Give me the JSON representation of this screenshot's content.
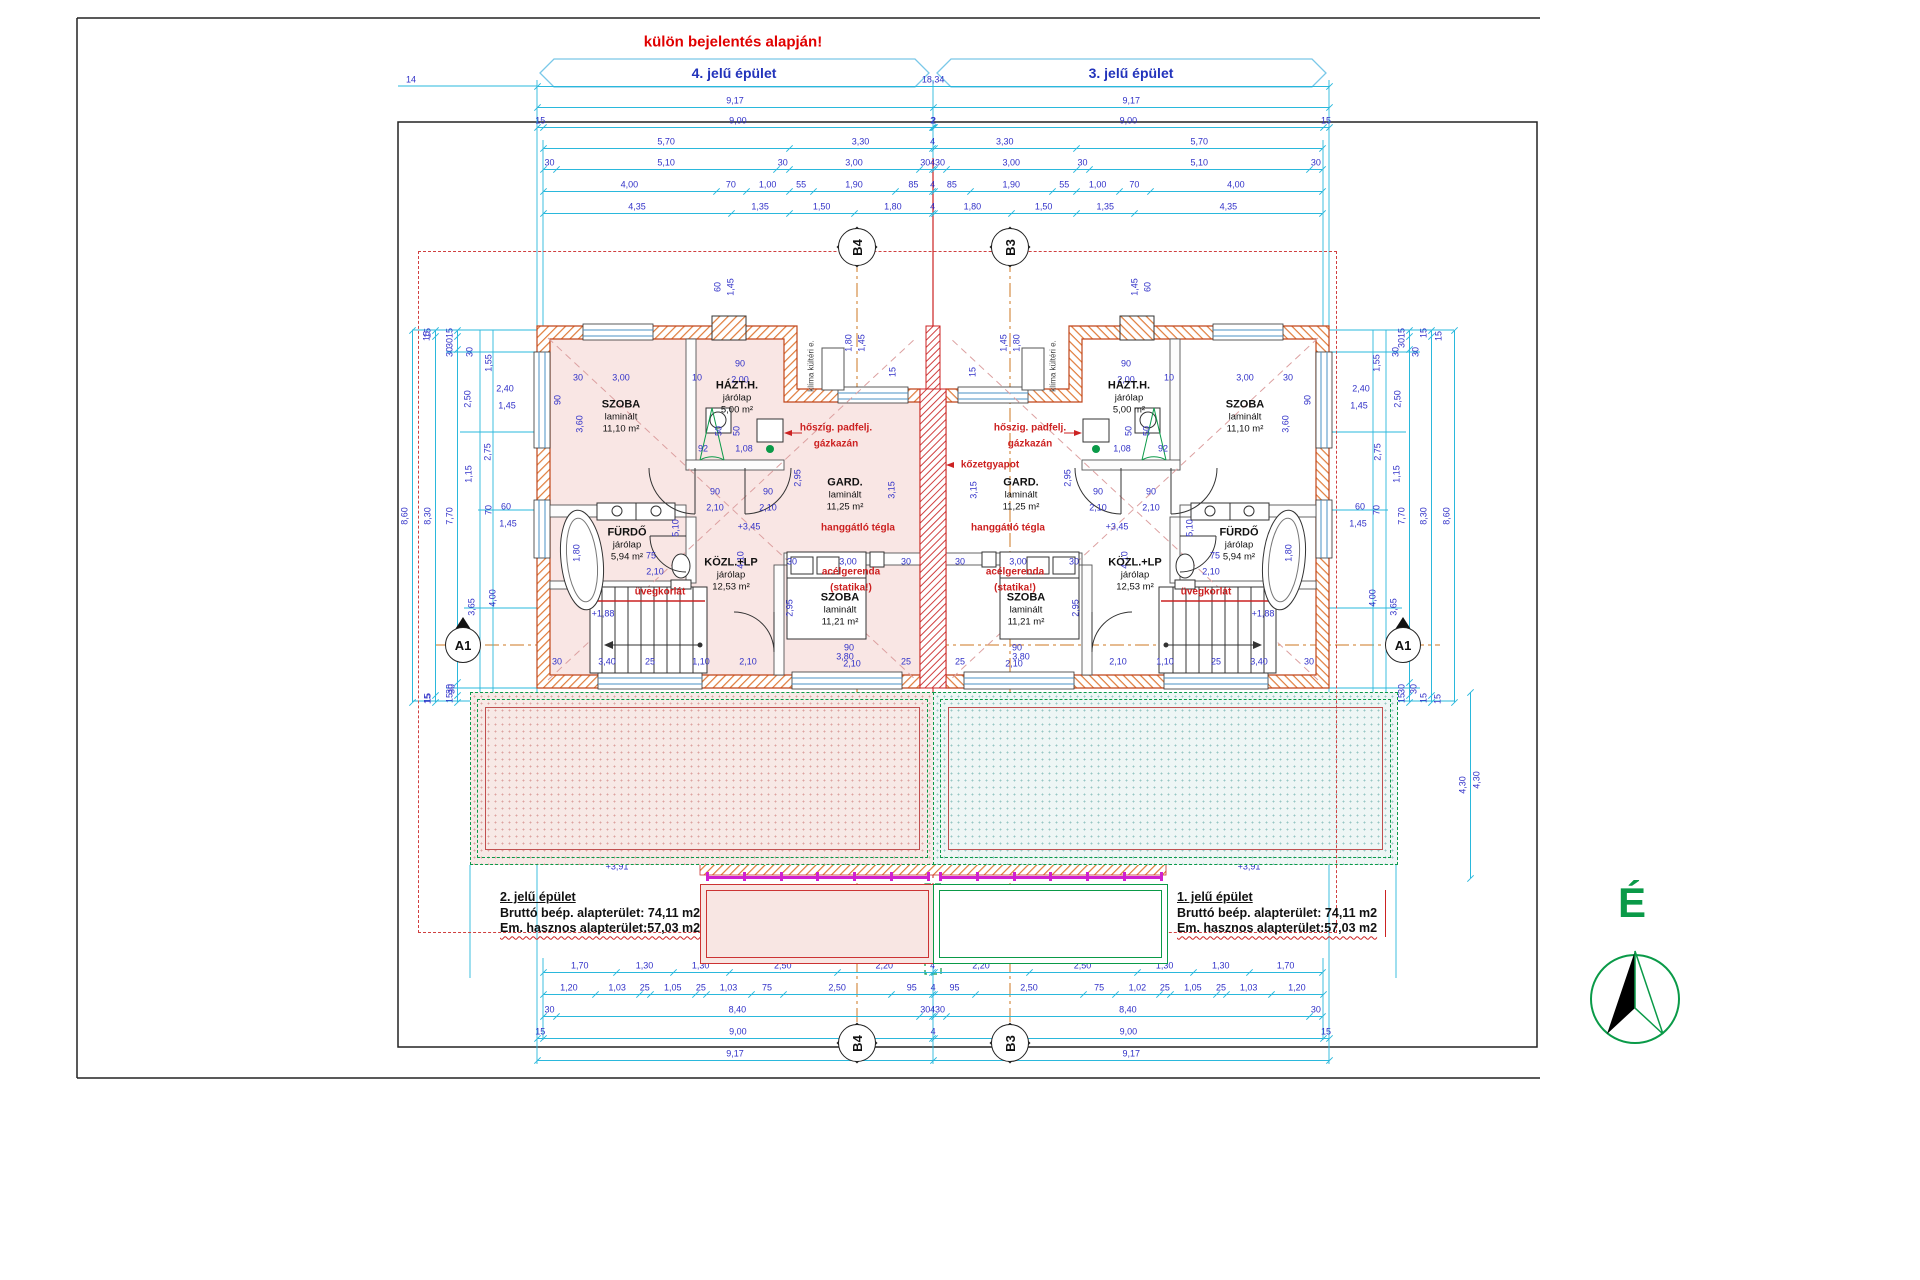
{
  "title": {
    "warning": "külön bejelentés alapján!",
    "left_banner": "4. jelű épület",
    "right_banner": "3. jelű épület"
  },
  "summaries": {
    "left": {
      "heading": "2. jelű épület",
      "line1": "Bruttó beép. alapterület: 74,11 m2",
      "line2": "Em. hasznos alapterület:57,03 m2"
    },
    "right": {
      "heading": "1. jelű épület",
      "line1": "Bruttó beép. alapterület: 74,11 m2",
      "line2": "Em. hasznos alapterület:57,03 m2"
    }
  },
  "compass": {
    "label": "É"
  },
  "colors": {
    "dim_line": "#2ab8dc",
    "dim_text": "#3232c8",
    "red": "#cc2020",
    "green": "#0a9a48",
    "wall": "#e07b39",
    "magenta": "#d020d0"
  },
  "markers": [
    {
      "t": "B4",
      "x": 857,
      "y": 247,
      "k": "grid"
    },
    {
      "t": "B3",
      "x": 1010,
      "y": 247,
      "k": "grid"
    },
    {
      "t": "B4",
      "x": 857,
      "y": 1043,
      "k": "grid"
    },
    {
      "t": "B3",
      "x": 1010,
      "y": 1043,
      "k": "grid"
    },
    {
      "t": "A1",
      "x": 463,
      "y": 645,
      "k": "sec"
    },
    {
      "t": "A1",
      "x": 1403,
      "y": 645,
      "k": "sec"
    }
  ],
  "rooms": [
    {
      "x": 621,
      "y": 417,
      "n": "SZOBA",
      "s": "laminált",
      "a": "11,10 m²"
    },
    {
      "x": 737,
      "y": 398,
      "n": "HÁZT.H.",
      "s": "járólap",
      "a": "5,00 m²"
    },
    {
      "x": 845,
      "y": 495,
      "n": "GARD.",
      "s": "laminált",
      "a": "11,25 m²"
    },
    {
      "x": 627,
      "y": 545,
      "n": "FÜRDŐ",
      "s": "járólap",
      "a": "5,94 m²"
    },
    {
      "x": 731,
      "y": 575,
      "n": "KÖZL.+LP",
      "s": "járólap",
      "a": "12,53 m²"
    },
    {
      "x": 840,
      "y": 610,
      "n": "SZOBA",
      "s": "laminált",
      "a": "11,21 m²"
    },
    {
      "x": 1245,
      "y": 417,
      "n": "SZOBA",
      "s": "laminált",
      "a": "11,10 m²"
    },
    {
      "x": 1129,
      "y": 398,
      "n": "HÁZT.H.",
      "s": "járólap",
      "a": "5,00 m²"
    },
    {
      "x": 1021,
      "y": 495,
      "n": "GARD.",
      "s": "laminált",
      "a": "11,25 m²"
    },
    {
      "x": 1239,
      "y": 545,
      "n": "FÜRDŐ",
      "s": "járólap",
      "a": "5,94 m²"
    },
    {
      "x": 1135,
      "y": 575,
      "n": "KÖZL.+LP",
      "s": "járólap",
      "a": "12,53 m²"
    },
    {
      "x": 1026,
      "y": 610,
      "n": "SZOBA",
      "s": "laminált",
      "a": "11,21 m²"
    }
  ],
  "annotations": [
    {
      "t": "hőszig. padfelj.",
      "x": 836,
      "y": 428
    },
    {
      "t": "gázkazán",
      "x": 836,
      "y": 444
    },
    {
      "t": "hőszig. padfelj.",
      "x": 1030,
      "y": 428
    },
    {
      "t": "gázkazán",
      "x": 1030,
      "y": 444
    },
    {
      "t": "kőzetgyapot",
      "x": 990,
      "y": 465
    },
    {
      "t": "hanggátló tégla",
      "x": 858,
      "y": 528
    },
    {
      "t": "hanggátló tégla",
      "x": 1008,
      "y": 528
    },
    {
      "t": "acélgerenda",
      "x": 851,
      "y": 572
    },
    {
      "t": "(statika!)",
      "x": 851,
      "y": 588
    },
    {
      "t": "acélgerenda",
      "x": 1015,
      "y": 572
    },
    {
      "t": "(statika!)",
      "x": 1015,
      "y": 588
    },
    {
      "t": "üvegkorlát",
      "x": 660,
      "y": 592
    },
    {
      "t": "üvegkorlát",
      "x": 1206,
      "y": 592
    },
    {
      "t": "nem járható lapostető",
      "x": 762,
      "y": 777,
      "cls": "huge"
    },
    {
      "t": "nem járható lapostető",
      "x": 1104,
      "y": 777,
      "cls": "huge"
    },
    {
      "t": "korcolt alu lem.pfedés",
      "x": 816,
      "y": 921,
      "cls": "brown"
    },
    {
      "t": "korcolt alu lem.pfedés",
      "x": 1050,
      "y": 921,
      "cls": "brown"
    },
    {
      "t": "klíma kültéri e.",
      "x": 812,
      "y": 366,
      "cls": "small r"
    },
    {
      "t": "klíma kültéri e.",
      "x": 1054,
      "y": 366,
      "cls": "small r"
    }
  ],
  "dim_chains": [
    {
      "d": "h",
      "x": 537,
      "y": 86,
      "v": [
        "18,34"
      ]
    },
    {
      "d": "h",
      "x": 537,
      "y": 107,
      "v": [
        "9,17",
        "9,17"
      ]
    },
    {
      "d": "h",
      "x": 537,
      "y": 127,
      "v": [
        "15",
        "9,00",
        "2",
        "2",
        "9,00",
        "15"
      ]
    },
    {
      "d": "h",
      "x": 543,
      "y": 148,
      "v": [
        "5,70",
        "3,30",
        "4",
        "3,30",
        "5,70"
      ]
    },
    {
      "d": "h",
      "x": 543,
      "y": 169,
      "v": [
        "30",
        "5,10",
        "30",
        "3,00",
        "30",
        "4",
        "30",
        "3,00",
        "30",
        "5,10",
        "30"
      ]
    },
    {
      "d": "h",
      "x": 543,
      "y": 191,
      "v": [
        "4,00",
        "70",
        "1,00",
        "55",
        "1,90",
        "85",
        "4",
        "85",
        "1,90",
        "55",
        "1,00",
        "70",
        "4,00"
      ]
    },
    {
      "d": "h",
      "x": 543,
      "y": 213,
      "v": [
        "4,35",
        "1,35",
        "1,50",
        "1,80",
        "4",
        "1,80",
        "1,50",
        "1,35",
        "4,35"
      ]
    },
    {
      "d": "h",
      "x": 543,
      "y": 972,
      "v": [
        "1,70",
        "1,30",
        "1,30",
        "2,50",
        "2,20",
        "4",
        "2,20",
        "2,50",
        "1,30",
        "1,30",
        "1,70"
      ]
    },
    {
      "d": "h",
      "x": 543,
      "y": 994,
      "v": [
        "1,20",
        "1,03",
        "25",
        "1,05",
        "25",
        "1,03",
        "75",
        "2,50",
        "95",
        "4",
        "95",
        "2,50",
        "75",
        "1,02",
        "25",
        "1,05",
        "25",
        "1,03",
        "1,20"
      ]
    },
    {
      "d": "h",
      "x": 543,
      "y": 1016,
      "v": [
        "30",
        "8,40",
        "30",
        "4",
        "30",
        "8,40",
        "30"
      ]
    },
    {
      "d": "h",
      "x": 537,
      "y": 1038,
      "v": [
        "15",
        "9,00",
        "4",
        "9,00",
        "15"
      ]
    },
    {
      "d": "h",
      "x": 537,
      "y": 1060,
      "v": [
        "9,17",
        "9,17"
      ]
    },
    {
      "d": "v",
      "x": 412,
      "y": 330,
      "v": [
        "8,60"
      ]
    },
    {
      "d": "v",
      "x": 435,
      "y": 330,
      "v": [
        "15",
        "8,30",
        "15"
      ]
    },
    {
      "d": "v",
      "x": 457,
      "y": 330,
      "v": [
        "15",
        "30",
        "7,70",
        "30",
        "15"
      ]
    },
    {
      "d": "v",
      "x": 1454,
      "y": 330,
      "v": [
        "8,60"
      ]
    },
    {
      "d": "v",
      "x": 1431,
      "y": 330,
      "v": [
        "15",
        "8,30",
        "15"
      ]
    },
    {
      "d": "v",
      "x": 1409,
      "y": 330,
      "v": [
        "15",
        "30",
        "7,70",
        "30",
        "15"
      ]
    },
    {
      "d": "v",
      "x": 1470,
      "y": 692,
      "v": [
        "4,30"
      ]
    }
  ],
  "dim_labels": [
    {
      "t": "14",
      "x": 411,
      "y": 80
    },
    {
      "t": "15",
      "x": 427,
      "y": 336,
      "r": 1
    },
    {
      "t": "30",
      "x": 450,
      "y": 352,
      "r": 1
    },
    {
      "t": "30",
      "x": 470,
      "y": 352,
      "r": 1
    },
    {
      "t": "1,55",
      "x": 489,
      "y": 363,
      "r": 1
    },
    {
      "t": "2,50",
      "x": 468,
      "y": 399,
      "r": 1
    },
    {
      "t": "2,75",
      "x": 488,
      "y": 452,
      "r": 1
    },
    {
      "t": "1,15",
      "x": 469,
      "y": 474,
      "r": 1
    },
    {
      "t": "70",
      "x": 489,
      "y": 510,
      "r": 1
    },
    {
      "t": "3,65",
      "x": 472,
      "y": 607,
      "r": 1
    },
    {
      "t": "4,00",
      "x": 493,
      "y": 598,
      "r": 1
    },
    {
      "t": "30",
      "x": 452,
      "y": 689,
      "r": 1
    },
    {
      "t": "15",
      "x": 428,
      "y": 699,
      "r": 1
    },
    {
      "t": "2,40",
      "x": 505,
      "y": 389
    },
    {
      "t": "1,45",
      "x": 507,
      "y": 406
    },
    {
      "t": "60",
      "x": 506,
      "y": 507
    },
    {
      "t": "1,45",
      "x": 508,
      "y": 524
    },
    {
      "t": "15",
      "x": 1439,
      "y": 336,
      "r": 1
    },
    {
      "t": "30",
      "x": 1416,
      "y": 352,
      "r": 1
    },
    {
      "t": "30",
      "x": 1396,
      "y": 352,
      "r": 1
    },
    {
      "t": "1,55",
      "x": 1377,
      "y": 363,
      "r": 1
    },
    {
      "t": "2,50",
      "x": 1398,
      "y": 399,
      "r": 1
    },
    {
      "t": "2,75",
      "x": 1378,
      "y": 452,
      "r": 1
    },
    {
      "t": "1,15",
      "x": 1397,
      "y": 474,
      "r": 1
    },
    {
      "t": "70",
      "x": 1377,
      "y": 510,
      "r": 1
    },
    {
      "t": "3,65",
      "x": 1394,
      "y": 607,
      "r": 1
    },
    {
      "t": "4,00",
      "x": 1373,
      "y": 598,
      "r": 1
    },
    {
      "t": "30",
      "x": 1414,
      "y": 689,
      "r": 1
    },
    {
      "t": "15",
      "x": 1438,
      "y": 699,
      "r": 1
    },
    {
      "t": "2,40",
      "x": 1361,
      "y": 389
    },
    {
      "t": "1,45",
      "x": 1359,
      "y": 406
    },
    {
      "t": "60",
      "x": 1360,
      "y": 507
    },
    {
      "t": "1,45",
      "x": 1358,
      "y": 524
    },
    {
      "t": "60",
      "x": 718,
      "y": 287,
      "r": 1
    },
    {
      "t": "1,45",
      "x": 731,
      "y": 287,
      "r": 1
    },
    {
      "t": "60",
      "x": 1148,
      "y": 287,
      "r": 1
    },
    {
      "t": "1,45",
      "x": 1135,
      "y": 287,
      "r": 1
    },
    {
      "t": "1,80",
      "x": 849,
      "y": 343,
      "r": 1
    },
    {
      "t": "1,45",
      "x": 862,
      "y": 343,
      "r": 1
    },
    {
      "t": "1,80",
      "x": 1017,
      "y": 343,
      "r": 1
    },
    {
      "t": "1,45",
      "x": 1004,
      "y": 343,
      "r": 1
    },
    {
      "t": "30",
      "x": 578,
      "y": 378
    },
    {
      "t": "3,00",
      "x": 621,
      "y": 378
    },
    {
      "t": "10",
      "x": 697,
      "y": 378
    },
    {
      "t": "90",
      "x": 740,
      "y": 364
    },
    {
      "t": "2,00",
      "x": 740,
      "y": 380
    },
    {
      "t": "30",
      "x": 1288,
      "y": 378
    },
    {
      "t": "3,00",
      "x": 1245,
      "y": 378
    },
    {
      "t": "10",
      "x": 1169,
      "y": 378
    },
    {
      "t": "90",
      "x": 1126,
      "y": 364
    },
    {
      "t": "2,00",
      "x": 1126,
      "y": 380
    },
    {
      "t": "90",
      "x": 558,
      "y": 400,
      "r": 1
    },
    {
      "t": "3,60",
      "x": 580,
      "y": 424,
      "r": 1
    },
    {
      "t": "90",
      "x": 1308,
      "y": 400,
      "r": 1
    },
    {
      "t": "3,60",
      "x": 1286,
      "y": 424,
      "r": 1
    },
    {
      "t": "92",
      "x": 703,
      "y": 449
    },
    {
      "t": "1,08",
      "x": 744,
      "y": 449
    },
    {
      "t": "92",
      "x": 1163,
      "y": 449
    },
    {
      "t": "1,08",
      "x": 1122,
      "y": 449
    },
    {
      "t": "50",
      "x": 719,
      "y": 431,
      "r": 1
    },
    {
      "t": "50",
      "x": 737,
      "y": 431,
      "r": 1
    },
    {
      "t": "50",
      "x": 1147,
      "y": 431,
      "r": 1
    },
    {
      "t": "50",
      "x": 1129,
      "y": 431,
      "r": 1
    },
    {
      "t": "15",
      "x": 893,
      "y": 372,
      "r": 1
    },
    {
      "t": "15",
      "x": 973,
      "y": 372,
      "r": 1
    },
    {
      "t": "90",
      "x": 715,
      "y": 492
    },
    {
      "t": "2,10",
      "x": 715,
      "y": 508
    },
    {
      "t": "90",
      "x": 768,
      "y": 492
    },
    {
      "t": "2,10",
      "x": 768,
      "y": 508
    },
    {
      "t": "90",
      "x": 1151,
      "y": 492
    },
    {
      "t": "2,10",
      "x": 1151,
      "y": 508
    },
    {
      "t": "90",
      "x": 1098,
      "y": 492
    },
    {
      "t": "2,10",
      "x": 1098,
      "y": 508
    },
    {
      "t": "2,95",
      "x": 798,
      "y": 478,
      "r": 1
    },
    {
      "t": "3,15",
      "x": 892,
      "y": 490,
      "r": 1
    },
    {
      "t": "2,95",
      "x": 1068,
      "y": 478,
      "r": 1
    },
    {
      "t": "3,15",
      "x": 974,
      "y": 490,
      "r": 1
    },
    {
      "t": "30",
      "x": 792,
      "y": 562
    },
    {
      "t": "3,00",
      "x": 848,
      "y": 562
    },
    {
      "t": "30",
      "x": 906,
      "y": 562
    },
    {
      "t": "30",
      "x": 1074,
      "y": 562
    },
    {
      "t": "3,00",
      "x": 1018,
      "y": 562
    },
    {
      "t": "30",
      "x": 960,
      "y": 562
    },
    {
      "t": "+3,45",
      "x": 749,
      "y": 527
    },
    {
      "t": "+3,45",
      "x": 1117,
      "y": 527
    },
    {
      "t": "4,10",
      "x": 741,
      "y": 560,
      "r": 1
    },
    {
      "t": "4,10",
      "x": 1125,
      "y": 560,
      "r": 1
    },
    {
      "t": "75",
      "x": 651,
      "y": 556
    },
    {
      "t": "2,10",
      "x": 655,
      "y": 572
    },
    {
      "t": "75",
      "x": 1215,
      "y": 556
    },
    {
      "t": "2,10",
      "x": 1211,
      "y": 572
    },
    {
      "t": "1,80",
      "x": 577,
      "y": 553,
      "r": 1
    },
    {
      "t": "1,80",
      "x": 1289,
      "y": 553,
      "r": 1
    },
    {
      "t": "5,10",
      "x": 676,
      "y": 528,
      "r": 1
    },
    {
      "t": "5,10",
      "x": 1190,
      "y": 528,
      "r": 1
    },
    {
      "t": "+1,88",
      "x": 603,
      "y": 614
    },
    {
      "t": "+1,88",
      "x": 1263,
      "y": 614
    },
    {
      "t": "90",
      "x": 849,
      "y": 648
    },
    {
      "t": "2,10",
      "x": 852,
      "y": 664
    },
    {
      "t": "90",
      "x": 1017,
      "y": 648
    },
    {
      "t": "2,10",
      "x": 1014,
      "y": 664
    },
    {
      "t": "2,95",
      "x": 790,
      "y": 608,
      "r": 1
    },
    {
      "t": "2,95",
      "x": 1076,
      "y": 608,
      "r": 1
    },
    {
      "t": "30",
      "x": 557,
      "y": 662
    },
    {
      "t": "3,40",
      "x": 607,
      "y": 662
    },
    {
      "t": "25",
      "x": 650,
      "y": 662
    },
    {
      "t": "1,10",
      "x": 701,
      "y": 662
    },
    {
      "t": "2,10",
      "x": 748,
      "y": 662
    },
    {
      "t": "3,80",
      "x": 845,
      "y": 657
    },
    {
      "t": "25",
      "x": 906,
      "y": 662
    },
    {
      "t": "30",
      "x": 1309,
      "y": 662
    },
    {
      "t": "3,40",
      "x": 1259,
      "y": 662
    },
    {
      "t": "25",
      "x": 1216,
      "y": 662
    },
    {
      "t": "1,10",
      "x": 1165,
      "y": 662
    },
    {
      "t": "2,10",
      "x": 1118,
      "y": 662
    },
    {
      "t": "3,80",
      "x": 1021,
      "y": 657
    },
    {
      "t": "25",
      "x": 960,
      "y": 662
    },
    {
      "t": "90",
      "x": 612,
      "y": 742,
      "r": 1
    },
    {
      "t": "2,10",
      "x": 624,
      "y": 742,
      "r": 1
    },
    {
      "t": "90",
      "x": 680,
      "y": 742,
      "r": 1
    },
    {
      "t": "2,10",
      "x": 692,
      "y": 742,
      "r": 1
    },
    {
      "t": "90",
      "x": 748,
      "y": 742,
      "r": 1
    },
    {
      "t": "2,10",
      "x": 760,
      "y": 742,
      "r": 1
    },
    {
      "t": "3,65",
      "x": 795,
      "y": 752,
      "r": 1
    },
    {
      "t": "3,50",
      "x": 809,
      "y": 752,
      "r": 1
    },
    {
      "t": "2,40",
      "x": 836,
      "y": 738,
      "r": 1
    },
    {
      "t": "2,10",
      "x": 848,
      "y": 738,
      "r": 1
    },
    {
      "t": "90",
      "x": 1254,
      "y": 742,
      "r": 1
    },
    {
      "t": "2,10",
      "x": 1242,
      "y": 742,
      "r": 1
    },
    {
      "t": "90",
      "x": 1186,
      "y": 742,
      "r": 1
    },
    {
      "t": "2,10",
      "x": 1174,
      "y": 742,
      "r": 1
    },
    {
      "t": "90",
      "x": 1118,
      "y": 742,
      "r": 1
    },
    {
      "t": "2,10",
      "x": 1106,
      "y": 742,
      "r": 1
    },
    {
      "t": "3,65",
      "x": 1071,
      "y": 752,
      "r": 1
    },
    {
      "t": "3,50",
      "x": 1057,
      "y": 752,
      "r": 1
    },
    {
      "t": "2,40",
      "x": 1030,
      "y": 738,
      "r": 1
    },
    {
      "t": "2,10",
      "x": 1018,
      "y": 738,
      "r": 1
    },
    {
      "t": "3,90",
      "x": 830,
      "y": 813
    },
    {
      "t": "3,90",
      "x": 1036,
      "y": 813
    },
    {
      "t": "27,74 m²",
      "x": 763,
      "y": 797
    },
    {
      "t": "27,74 m²",
      "x": 1103,
      "y": 797
    },
    {
      "t": "+3,58 (vízszig.)",
      "x": 664,
      "y": 844
    },
    {
      "t": "+3,58 (vízszig.)",
      "x": 1202,
      "y": 844
    },
    {
      "t": "+3,91",
      "x": 617,
      "y": 867
    },
    {
      "t": "+3,91",
      "x": 1249,
      "y": 867
    },
    {
      "t": "10",
      "x": 725,
      "y": 906
    },
    {
      "t": "3,50",
      "x": 816,
      "y": 906
    },
    {
      "t": "10",
      "x": 901,
      "y": 906
    },
    {
      "t": "57",
      "x": 922,
      "y": 906
    },
    {
      "t": "57",
      "x": 944,
      "y": 906
    },
    {
      "t": "10",
      "x": 965,
      "y": 906
    },
    {
      "t": "3,50",
      "x": 1050,
      "y": 906
    },
    {
      "t": "10",
      "x": 1141,
      "y": 906
    },
    {
      "t": "4,30",
      "x": 1477,
      "y": 780,
      "r": 1
    }
  ]
}
